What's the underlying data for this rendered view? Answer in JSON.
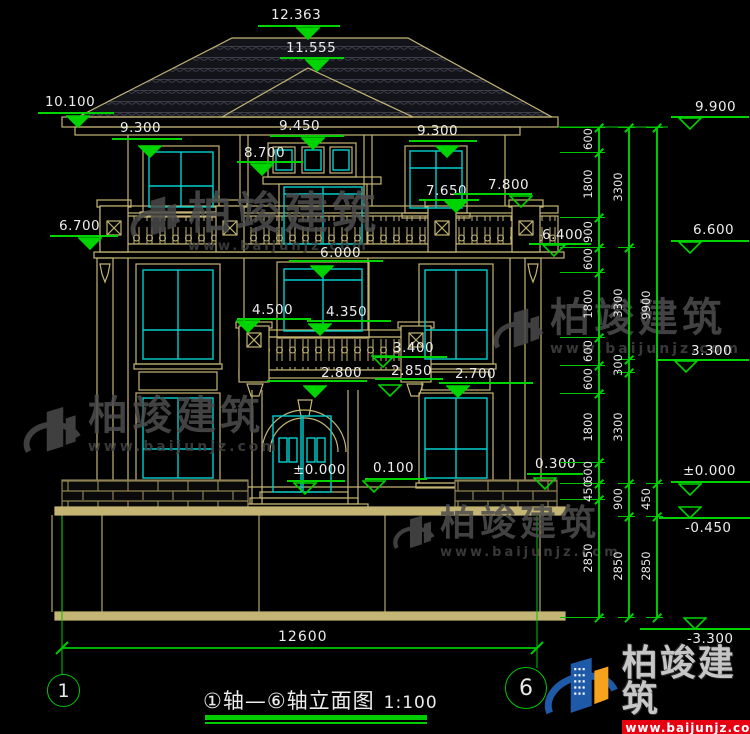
{
  "colors": {
    "green": "#00d400",
    "tan": "#C4B574",
    "cyan": "#00CFCF",
    "white": "#ececec",
    "brick_joint": "#8f8252",
    "red": "#e60012",
    "blue": "#1E5AA8",
    "orange": "#F6A21C",
    "gray": "#4c4c4c"
  },
  "watermark": {
    "name": "柏竣建筑",
    "url": "www.baijunjz.com"
  },
  "brand": {
    "name": "柏竣建筑",
    "url": "www.baijunjz.com"
  },
  "title": {
    "text": "①轴—⑥轴立面图",
    "scale": "1:100"
  },
  "axes": {
    "left": "1",
    "right": "6"
  },
  "bottom_dim": {
    "label": "12600"
  },
  "elevation_markers": [
    {
      "label": "12.363",
      "text": [
        271,
        7
      ],
      "line": [
        258,
        25,
        82
      ],
      "tri": [
        308,
        38
      ],
      "filled": true
    },
    {
      "label": "11.555",
      "text": [
        286,
        40
      ],
      "line": [
        280,
        57,
        64
      ],
      "tri": [
        317,
        70
      ],
      "filled": true
    },
    {
      "label": "10.100",
      "text": [
        45,
        94
      ],
      "line": [
        38,
        112,
        76
      ],
      "tri": [
        78,
        126
      ],
      "filled": true
    },
    {
      "label": "9.300",
      "text": [
        120,
        120
      ],
      "line": [
        112,
        138,
        70
      ],
      "tri": [
        150,
        156
      ],
      "filled": true
    },
    {
      "label": "9.450",
      "text": [
        279,
        118
      ],
      "line": [
        270,
        135,
        74
      ],
      "tri": [
        313,
        148
      ],
      "filled": true
    },
    {
      "label": "9.300",
      "text": [
        417,
        123
      ],
      "line": [
        409,
        140,
        68
      ],
      "tri": [
        447,
        156
      ],
      "filled": true
    },
    {
      "label": "8.700",
      "text": [
        244,
        145
      ],
      "line": [
        237,
        161,
        66
      ],
      "tri": [
        262,
        174
      ],
      "filled": true
    },
    {
      "label": "7.650",
      "text": [
        426,
        183
      ],
      "line": [
        419,
        199,
        60
      ],
      "tri": [
        456,
        211
      ],
      "filled": true
    },
    {
      "label": "7.800",
      "text": [
        488,
        177
      ],
      "line": [
        454,
        193,
        78
      ],
      "tri": [
        521,
        206
      ],
      "filled": false
    },
    {
      "label": "6.700",
      "text": [
        59,
        218
      ],
      "line": [
        50,
        235,
        68
      ],
      "tri": [
        90,
        248
      ],
      "filled": true
    },
    {
      "label": "6.400",
      "text": [
        542,
        227
      ],
      "line": [
        529,
        243,
        62
      ],
      "tri": [
        554,
        255
      ],
      "filled": false
    },
    {
      "label": "6.000",
      "text": [
        320,
        245
      ],
      "line": [
        289,
        260,
        94
      ],
      "tri": [
        322,
        276
      ],
      "filled": true
    },
    {
      "label": "4.500",
      "text": [
        252,
        302
      ],
      "line": [
        237,
        318,
        74
      ],
      "tri": [
        248,
        331
      ],
      "filled": true
    },
    {
      "label": "4.350",
      "text": [
        326,
        304
      ],
      "line": [
        307,
        320,
        84
      ],
      "tri": [
        320,
        334
      ],
      "filled": true
    },
    {
      "label": "3.400",
      "text": [
        393,
        340
      ],
      "line": [
        375,
        356,
        72
      ],
      "tri": [
        383,
        366
      ],
      "filled": false
    },
    {
      "label": "2.850",
      "text": [
        391,
        363
      ],
      "line": [
        375,
        378,
        68
      ],
      "tri": [
        390,
        395
      ],
      "filled": false
    },
    {
      "label": "2.800",
      "text": [
        321,
        365
      ],
      "line": [
        267,
        380,
        100
      ],
      "tri": [
        315,
        396
      ],
      "filled": true
    },
    {
      "label": "2.700",
      "text": [
        455,
        366
      ],
      "line": [
        439,
        382,
        94
      ],
      "tri": [
        458,
        396
      ],
      "filled": true
    },
    {
      "label": "±0.000",
      "text": [
        293,
        462
      ],
      "line": [
        287,
        480,
        58
      ],
      "tri": [
        305,
        493
      ],
      "filled": false
    },
    {
      "label": "0.100",
      "text": [
        373,
        460
      ],
      "line": [
        365,
        478,
        62
      ],
      "tri": [
        374,
        491
      ],
      "filled": false
    },
    {
      "label": "0.300",
      "text": [
        535,
        456
      ],
      "line": [
        527,
        473,
        56
      ],
      "tri": [
        545,
        488
      ],
      "filled": false
    },
    {
      "label": "9.900",
      "text": [
        695,
        99
      ],
      "line": [
        671,
        116,
        78
      ],
      "tri": [
        690,
        128
      ],
      "filled": false
    },
    {
      "label": "6.600",
      "text": [
        693,
        222
      ],
      "line": [
        671,
        240,
        78
      ],
      "tri": [
        690,
        252
      ],
      "filled": false
    },
    {
      "label": "3.300",
      "text": [
        691,
        343
      ],
      "line": [
        657,
        359,
        92
      ],
      "tri": [
        686,
        371
      ],
      "filled": false
    },
    {
      "label": "±0.000",
      "text": [
        683,
        463
      ],
      "line": [
        671,
        481,
        79
      ],
      "tri": [
        690,
        494
      ],
      "filled": false
    },
    {
      "label": "-0.450",
      "text": [
        685,
        520
      ],
      "line": [
        659,
        517,
        91
      ],
      "tri": [
        690,
        517
      ],
      "filled": false
    },
    {
      "label": "-3.300",
      "text": [
        687,
        631
      ],
      "line": [
        640,
        628,
        110
      ],
      "tri": [
        695,
        628
      ],
      "filled": false
    }
  ],
  "dimension_chains": [
    {
      "x": 598,
      "y1": 127,
      "y2": 617,
      "stub": 38,
      "ticks": [
        127,
        152,
        217,
        247,
        272,
        337,
        365,
        393,
        462,
        483,
        499,
        617
      ],
      "labels": [
        {
          "t": "600",
          "y": 139
        },
        {
          "t": "1800",
          "y": 184
        },
        {
          "t": "900",
          "y": 232
        },
        {
          "t": "600",
          "y": 259
        },
        {
          "t": "1800",
          "y": 304
        },
        {
          "t": "600",
          "y": 351
        },
        {
          "t": "600",
          "y": 379
        },
        {
          "t": "1800",
          "y": 427
        },
        {
          "t": "600",
          "y": 472
        },
        {
          "t": "450",
          "y": 491
        },
        {
          "t": "2850",
          "y": 558
        }
      ]
    },
    {
      "x": 628,
      "y1": 127,
      "y2": 617,
      "stub": 10,
      "ticks": [
        127,
        247,
        359,
        372,
        483,
        516,
        617
      ],
      "labels": [
        {
          "t": "3300",
          "y": 187
        },
        {
          "t": "3300",
          "y": 303
        },
        {
          "t": "300",
          "y": 365
        },
        {
          "t": "3300",
          "y": 427
        },
        {
          "t": "900",
          "y": 499
        },
        {
          "t": "2850",
          "y": 566
        }
      ]
    },
    {
      "x": 656,
      "y1": 127,
      "y2": 617,
      "stub": 10,
      "ticks": [
        127,
        483,
        516,
        617
      ],
      "labels": [
        {
          "t": "9900",
          "y": 305
        },
        {
          "t": "450",
          "y": 499
        },
        {
          "t": "2850",
          "y": 566
        }
      ]
    }
  ]
}
